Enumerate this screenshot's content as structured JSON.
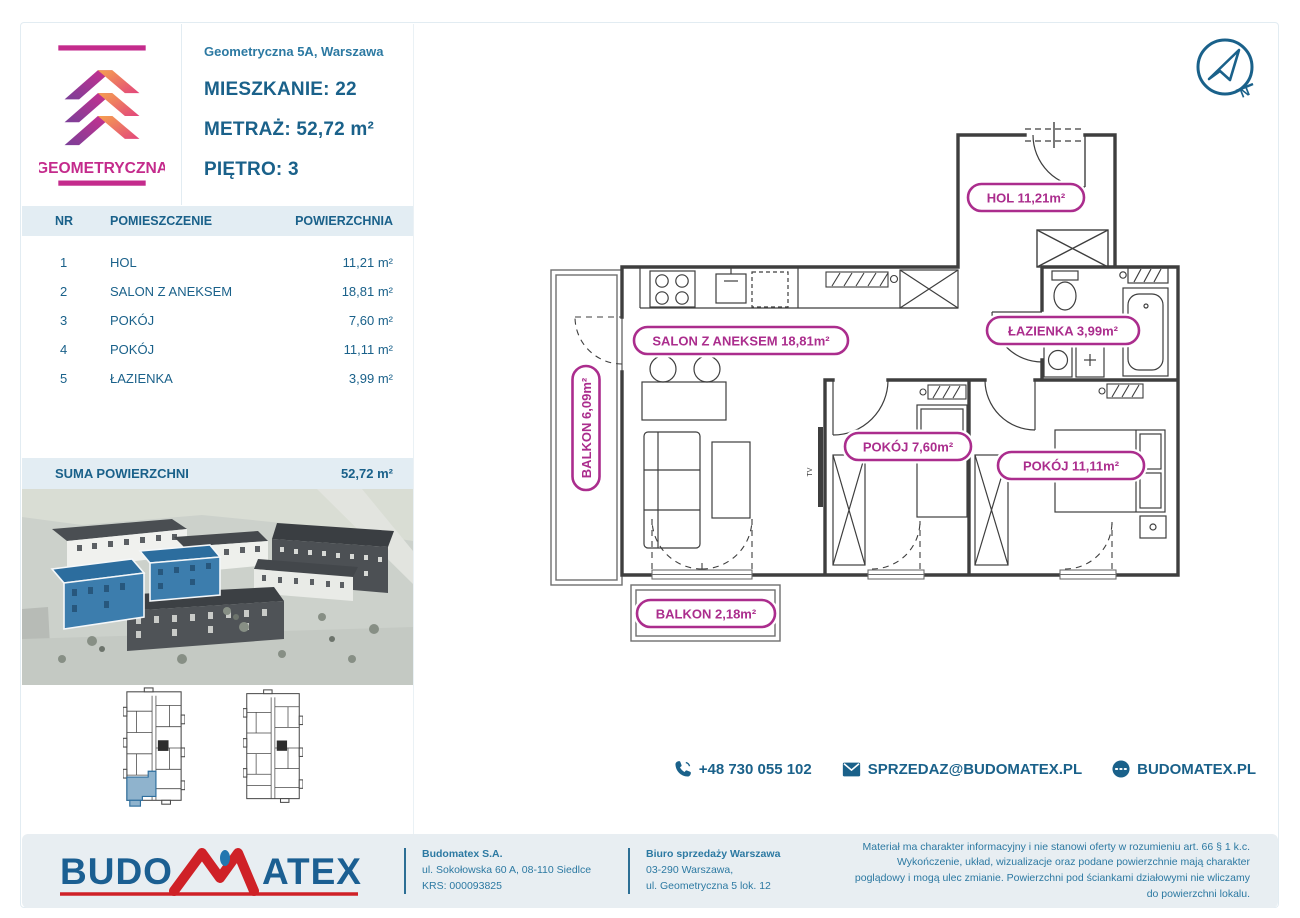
{
  "logo": {
    "text": "GEOMETRYCZNA"
  },
  "header": {
    "address": "Geometryczna 5A, Warszawa",
    "unit_label": "MIESZKANIE:",
    "unit_value": "22",
    "area_label": "METRAŻ:",
    "area_value": "52,72 m²",
    "floor_label": "PIĘTRO:",
    "floor_value": "3"
  },
  "rooms_table": {
    "headers": {
      "nr": "NR",
      "name": "POMIESZCZENIE",
      "area": "POWIERZCHNIA"
    },
    "rows": [
      {
        "nr": "1",
        "name": "HOL",
        "area": "11,21 m²"
      },
      {
        "nr": "2",
        "name": "SALON Z ANEKSEM",
        "area": "18,81 m²"
      },
      {
        "nr": "3",
        "name": "POKÓJ",
        "area": "7,60 m²"
      },
      {
        "nr": "4",
        "name": "POKÓJ",
        "area": "11,11 m²"
      },
      {
        "nr": "5",
        "name": "ŁAZIENKA",
        "area": "3,99 m²"
      }
    ],
    "sum_label": "SUMA POWIERZCHNI",
    "sum_value": "52,72 m²"
  },
  "floor_plan": {
    "labels": {
      "hol": "HOL 11,21m²",
      "salon": "SALON Z ANEKSEM 18,81m²",
      "lazienka": "ŁAZIENKA 3,99m²",
      "pokoj_3": "POKÓJ 7,60m²",
      "pokoj_4": "POKÓJ 11,11m²",
      "balkon_left": "BALKON 6,09m²",
      "balkon_bottom": "BALKON 2,18m²"
    },
    "tv_label": "TV",
    "compass_north": "N"
  },
  "contact": {
    "phone": "+48 730 055 102",
    "email": "SPRZEDAZ@BUDOMATEX.PL",
    "website": "BUDOMATEX.PL"
  },
  "footer": {
    "brand_part1": "BUDO",
    "brand_part2": "ATEX",
    "company": {
      "name": "Budomatex S.A.",
      "address": "ul. Sokołowska 60 A, 08-110 Siedlce",
      "krs": "KRS: 000093825"
    },
    "office": {
      "name": "Biuro sprzedaży Warszawa",
      "line1": "03-290 Warszawa,",
      "line2": "ul. Geometryczna 5 lok. 12"
    },
    "legal": "Materiał ma charakter informacyjny i nie stanowi oferty w rozumieniu art. 66 § 1 k.c. Wykończenie, układ, wizualizacje oraz podane powierzchnie mają charakter poglądowy i mogą ulec zmianie. Powierzchni pod ściankami działowymi nie wliczamy do powierzchni lokalu."
  },
  "colors": {
    "accent_blue": "#1a618a",
    "label_magenta": "#ab2d8d",
    "band_bg": "#e3edf3",
    "brand_red": "#cf2127",
    "highlight_building_blue": "#3c7dad"
  }
}
